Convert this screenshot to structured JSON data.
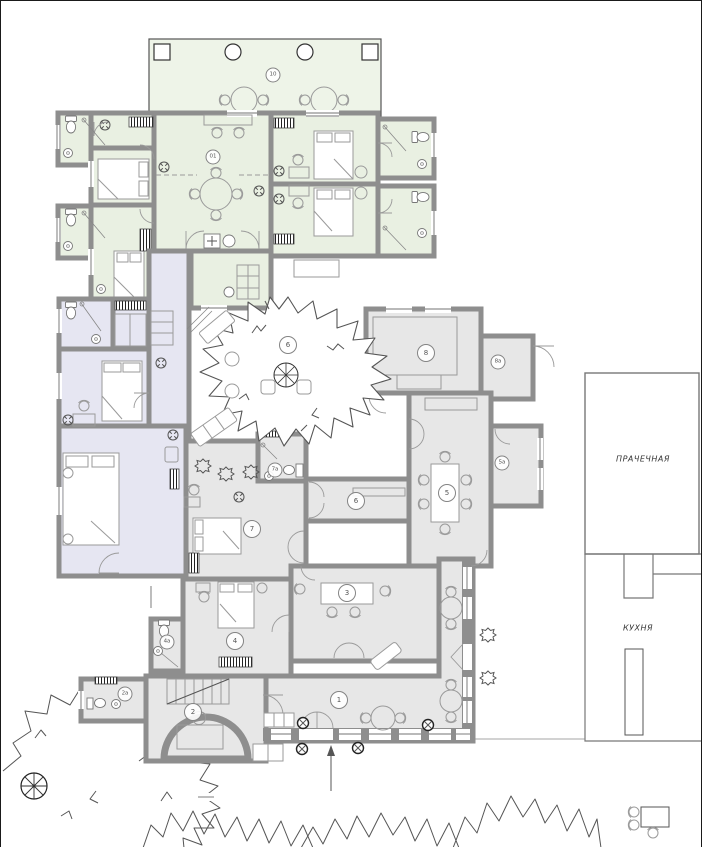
{
  "page": {
    "background": "#ffffff",
    "border_color": "#1a1a1a"
  },
  "colors": {
    "wall": "#8e8e8e",
    "green_room": "#e9f0e2",
    "terrace": "#eef4e8",
    "lavender_room": "#e6e6f2",
    "gray_room": "#e7e7e7",
    "line": "#555555",
    "furniture": "#9a9a9a"
  },
  "room_labels": {
    "terrace": "10",
    "lounge": "01",
    "courtyard": "6",
    "hall": "6",
    "veranda": "1",
    "cabinet": "2",
    "bath_2a": "2а",
    "salon": "3",
    "bedroom_4": "4",
    "bath_4a": "4а",
    "dining": "5",
    "pantry_5a": "5а",
    "bedroom_7": "7",
    "bath_7a": "7а",
    "room_8": "8",
    "room_8a": "8а"
  },
  "annex": {
    "laundry": "ПРАЧЕЧНАЯ",
    "kitchen": "КУХНЯ"
  }
}
